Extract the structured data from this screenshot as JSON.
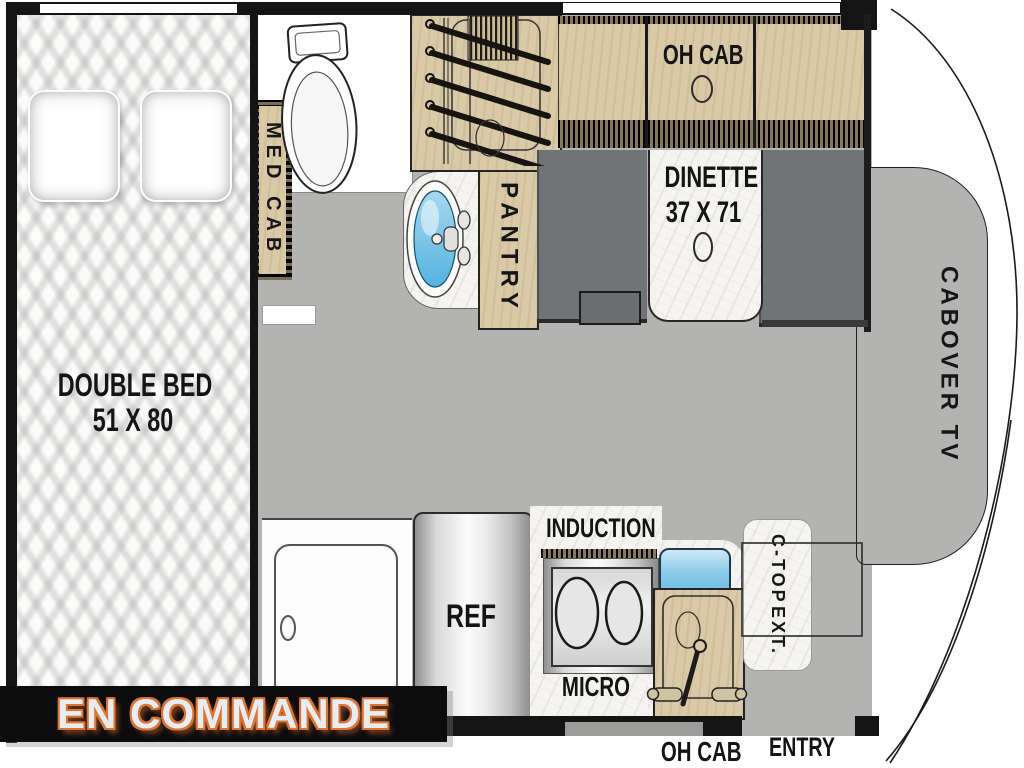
{
  "floorplan": {
    "bedroom": {
      "bed_label": "DOUBLE BED",
      "bed_size": "51 X 80"
    },
    "bathroom": {
      "med_cab_label": "MED CAB"
    },
    "galley": {
      "pantry_label": "PANTRY",
      "fridge_label": "REF",
      "cooktop_label": "INDUCTION",
      "microwave_label": "MICRO",
      "sink_overhead_cab_label": "OH CAB",
      "counter_ext_line1": "C-TOP",
      "counter_ext_line2": "EXT."
    },
    "dinette": {
      "label": "DINETTE",
      "size": "37 X 71",
      "overhead_cab_label": "OH CAB"
    },
    "cab": {
      "tv_label": "CABOVER TV",
      "entry_label": "ENTRY"
    },
    "status_banner": {
      "text": "EN COMMANDE"
    },
    "colors": {
      "floor_gray": "#b3b4b1",
      "cabinet_wood": "#d9c9a6",
      "bench_gray": "#717476",
      "sink_water_blue": "#5fb9e3",
      "counter_marble": "#f5f4f1",
      "banner_bg": "#0c0c0c",
      "banner_text": "#e9edf2",
      "banner_outline": "#dd7434"
    }
  }
}
